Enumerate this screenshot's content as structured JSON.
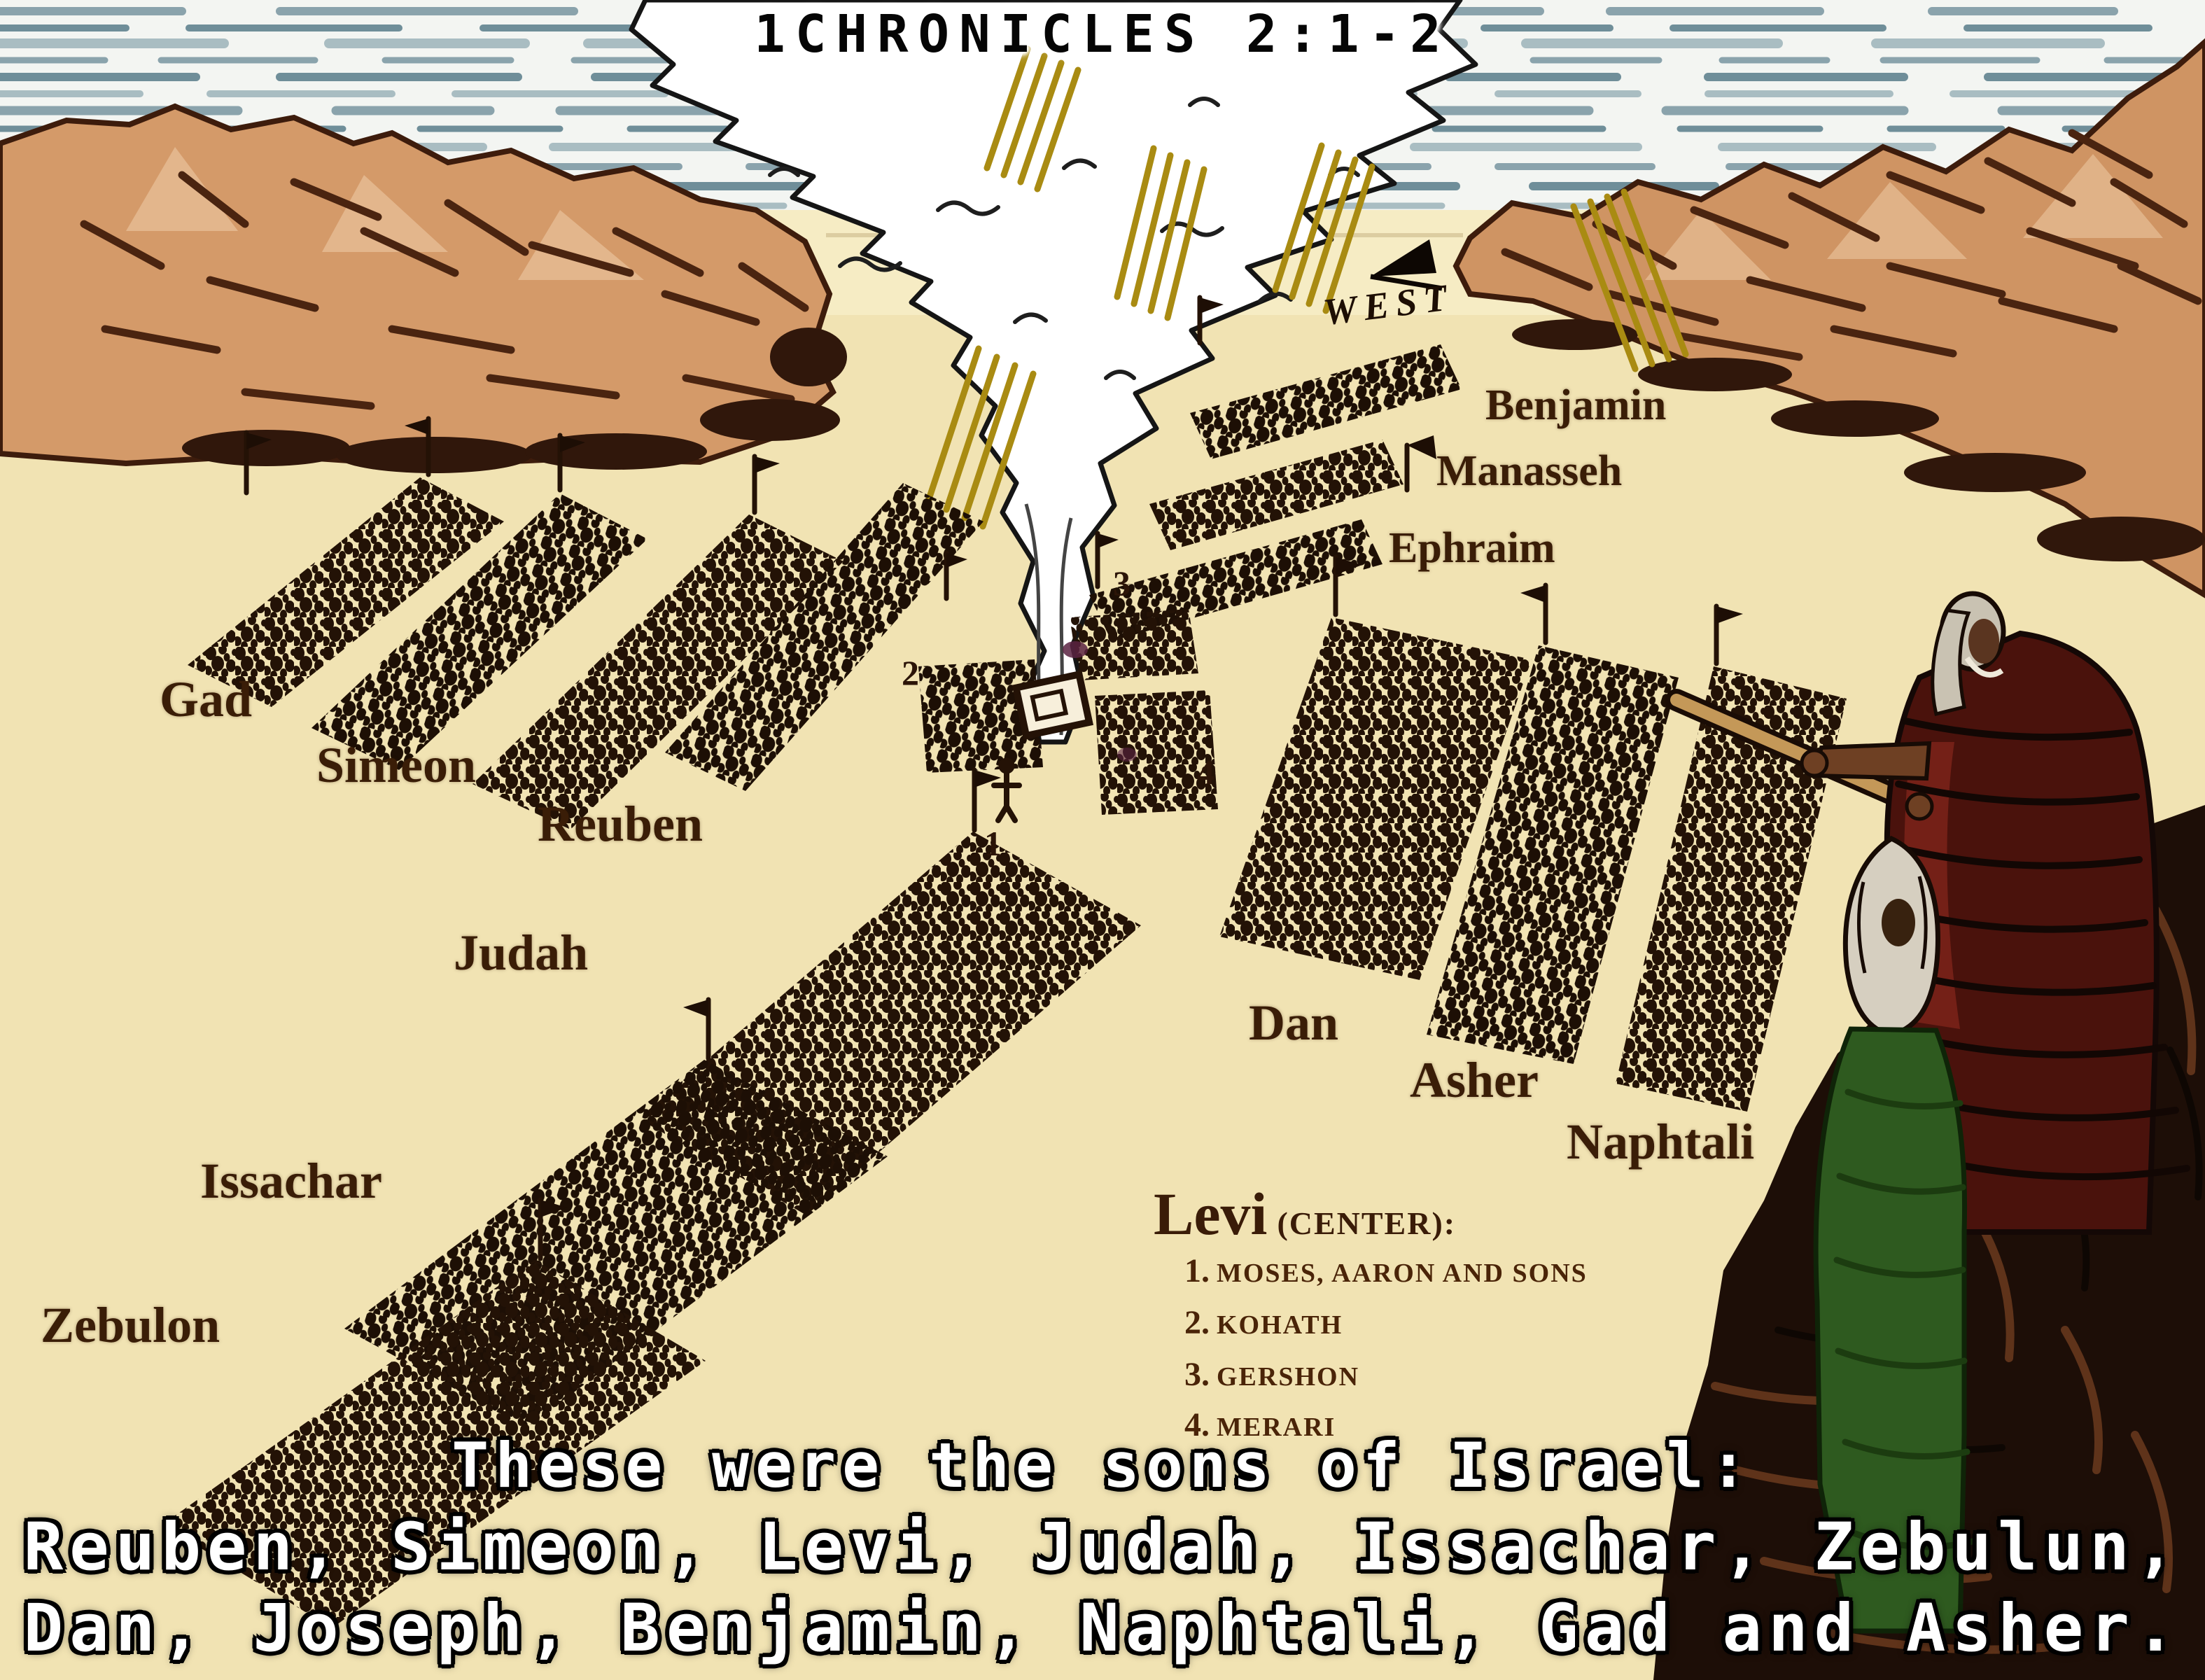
{
  "title": "1CHRONICLES 2:1-2",
  "direction_label": "WEST",
  "tribes": {
    "gad": "Gad",
    "simeon": "Simeon",
    "reuben": "Reuben",
    "judah": "Judah",
    "issachar": "Issachar",
    "zebulon": "Zebulon",
    "dan": "Dan",
    "asher": "Asher",
    "naphtali": "Naphtali",
    "benjamin": "Benjamin",
    "manasseh": "Manasseh",
    "ephraim": "Ephraim"
  },
  "levi": {
    "heading": "Levi",
    "center_note": "(CENTER):",
    "items": [
      {
        "num": "1.",
        "text": "MOSES, AARON AND SONS"
      },
      {
        "num": "2.",
        "text": "KOHATH"
      },
      {
        "num": "3.",
        "text": "GERSHON"
      },
      {
        "num": "4.",
        "text": "MERARI"
      }
    ]
  },
  "camp_markers": {
    "m1": "1",
    "m2": "2",
    "m3": "3",
    "m4": "4"
  },
  "caption": {
    "line1": "These were the sons of Israel:",
    "line2": "Reuben, Simeon, Levi, Judah, Issachar, Zebulun,",
    "line3": "Dan, Joseph, Benjamin, Naphtali, Gad and Asher."
  },
  "colors": {
    "sand": "#f1e3b3",
    "sky": "#f3f5f2",
    "sky_streak": "#8aa3ac",
    "mountain": "#d49a69",
    "mountain_shadow": "#4a2410",
    "camp_ink": "#231206",
    "label_brown": "#3a1d07",
    "ray_gold": "#a98b12",
    "caption_white": "#ffffff",
    "robe_red": "#4a120c",
    "garment_green": "#2e5a1f",
    "rock_dark": "#1d0e07"
  }
}
